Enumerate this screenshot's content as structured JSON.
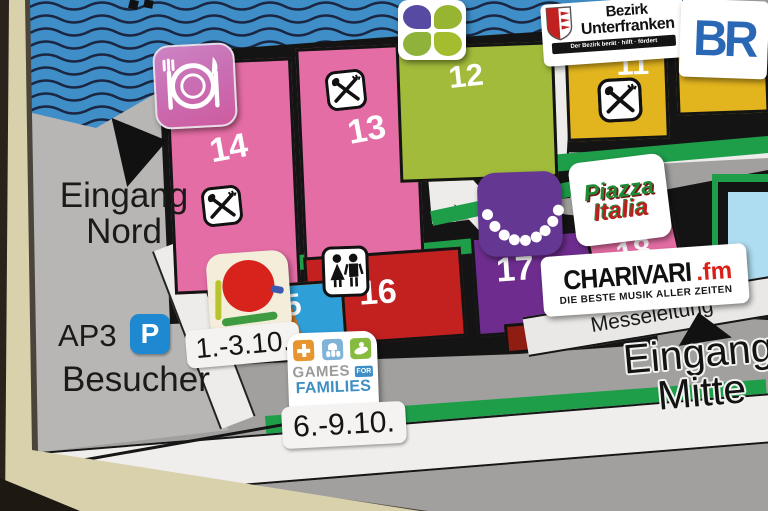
{
  "labels": {
    "eingang_nord_line1": "Eingang",
    "eingang_nord_line2": "Nord",
    "ap3": "AP3",
    "parking_p": "P",
    "besucher": "Besucher",
    "date_range_early": "1.-3.10.",
    "date_range_late": "6.-9.10.",
    "messeleitung": "Messeleitung",
    "eingang_mitte_line1": "Eingang",
    "eingang_mitte_line2": "Mitte"
  },
  "buildings": {
    "b10": "10",
    "b11": "11",
    "b12": "12",
    "b13": "13",
    "b14": "14",
    "b15": "15",
    "b16": "16",
    "b17": "17",
    "b18": "18"
  },
  "stickers": {
    "bezirk_line1": "Bezirk",
    "bezirk_line2": "Unterfranken",
    "bezirk_tagline": "Der Bezirk berät · hilft · fördert",
    "br": "BR",
    "piazza_line1": "Piazza",
    "piazza_line2": "Italia",
    "charivari_name": "CHARIVARI",
    "charivari_suffix": ".fm",
    "charivari_tagline": "DIE BESTE MUSIK ALLER ZEITEN",
    "games_line1": "GAMES",
    "games_for": "FOR",
    "games_line2": "FAMILIES"
  },
  "icons": {
    "restaurant": "restaurant-icon",
    "crossed_cutlery": "crossed-cutlery-icon",
    "clover": "clover-logo-icon",
    "necklace": "pearl-necklace-icon",
    "family": "family-icon",
    "red_dot": "red-dot-art-icon",
    "parking": "parking-icon"
  },
  "colors": {
    "water": "#3f8ec7",
    "wave_line": "#1b2742",
    "hall_pink": "#e56da5",
    "hall_green": "#a2bb3b",
    "hall_yellow": "#e2b41e",
    "hall_red": "#c32020",
    "hall_purple": "#6e2d8e",
    "hall_orange": "#de7a1f",
    "hall_blue": "#2f9fd8",
    "hall_lightblue": "#aedcf0",
    "path_green": "#1f9e4a",
    "map_gray": "#a1a09e",
    "frame_beige": "#d9d0ac",
    "accent_red": "#da1f16",
    "parking_blue": "#1e88d0"
  }
}
